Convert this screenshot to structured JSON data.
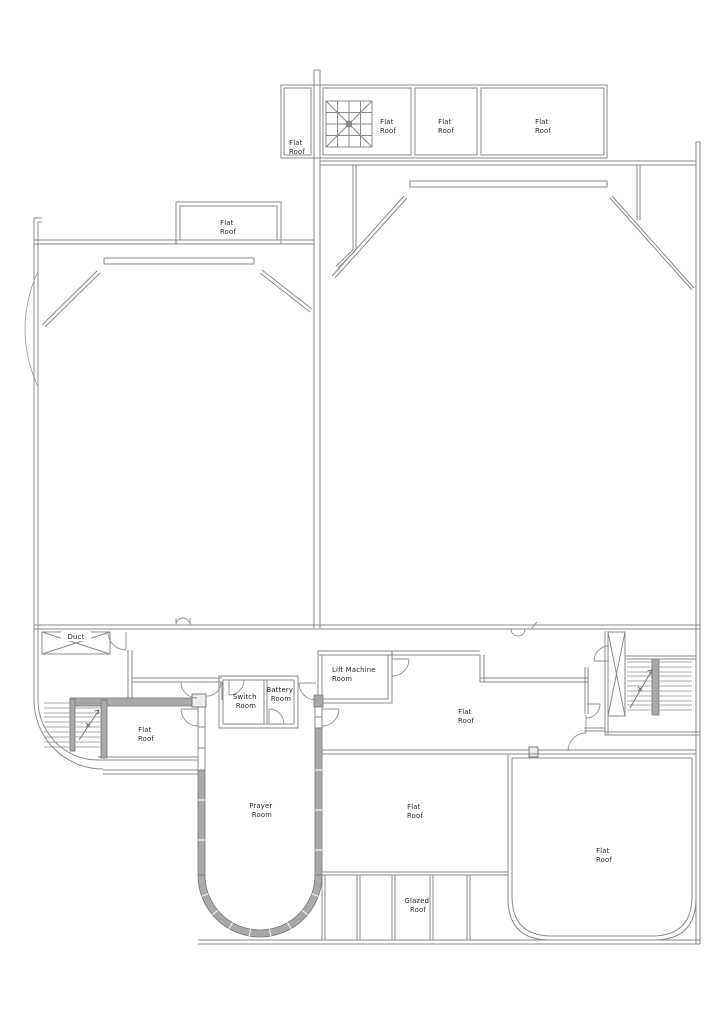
{
  "drawing": {
    "type": "architectural roof / floor plan",
    "colors": {
      "wall_line": "#8a8a8a",
      "wall_fill": "#a9a9a9",
      "wall_fill_edge": "#767676",
      "label_text": "#1f1f1f",
      "background": "#ffffff"
    },
    "rooms": [
      {
        "id": "flat-roof-strip",
        "label": "Flat Roof",
        "lines": [
          "Flat",
          "Roof"
        ]
      },
      {
        "id": "flat-roof-top-a",
        "label": "Flat Roof",
        "lines": [
          "Flat",
          "Roof"
        ]
      },
      {
        "id": "flat-roof-top-b",
        "label": "Flat Roof",
        "lines": [
          "Flat",
          "Roof"
        ]
      },
      {
        "id": "flat-roof-top-c",
        "label": "Flat Roof",
        "lines": [
          "Flat",
          "Roof"
        ]
      },
      {
        "id": "flat-roof-upper-left",
        "label": "Flat Roof",
        "lines": [
          "Flat",
          "Roof"
        ]
      },
      {
        "id": "duct",
        "label": "Duct",
        "lines": [
          "Duct"
        ]
      },
      {
        "id": "flat-roof-west",
        "label": "Flat Roof",
        "lines": [
          "Flat",
          "Roof"
        ]
      },
      {
        "id": "switch-room",
        "label": "Switch Room",
        "lines": [
          "Switch",
          "Room"
        ]
      },
      {
        "id": "battery-room",
        "label": "Battery Room",
        "lines": [
          "Battery",
          "Room"
        ]
      },
      {
        "id": "lift-machine-room",
        "label": "Lift Machine Room",
        "lines": [
          "Lift Machine",
          "Room"
        ]
      },
      {
        "id": "flat-roof-central",
        "label": "Flat Roof",
        "lines": [
          "Flat",
          "Roof"
        ]
      },
      {
        "id": "prayer-room",
        "label": "Prayer Room",
        "lines": [
          "Prayer",
          "Room"
        ]
      },
      {
        "id": "flat-roof-south",
        "label": "Flat Roof",
        "lines": [
          "Flat",
          "Roof"
        ]
      },
      {
        "id": "glazed-roof",
        "label": "Glazed Roof",
        "lines": [
          "Glazed",
          "Roof"
        ]
      },
      {
        "id": "flat-roof-southeast",
        "label": "Flat Roof",
        "lines": [
          "Flat",
          "Roof"
        ]
      }
    ]
  }
}
